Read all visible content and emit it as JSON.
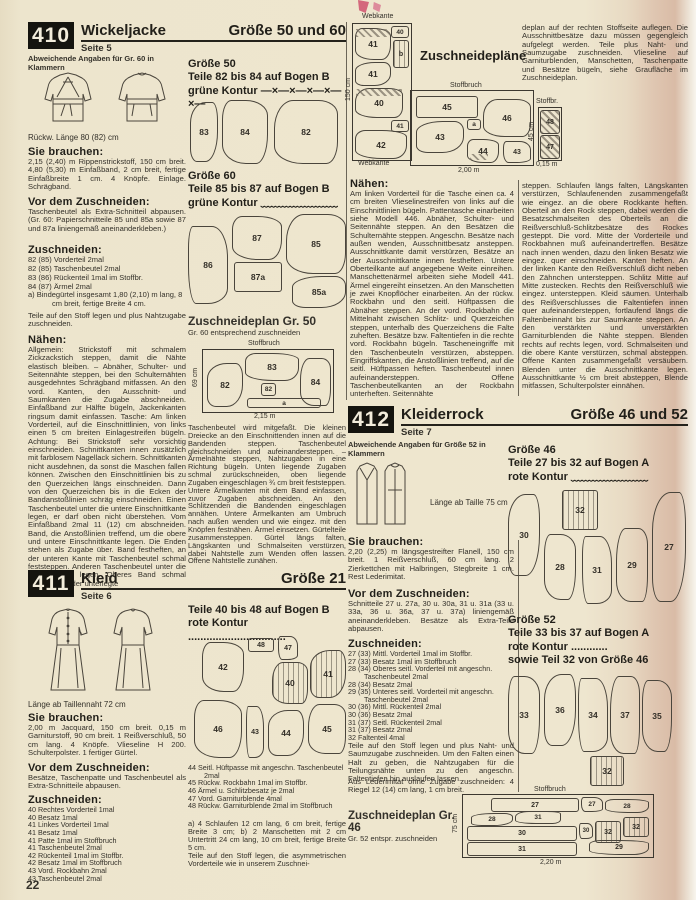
{
  "page": {
    "number": "22"
  },
  "labels": {
    "need": "Sie brauchen:",
    "before": "Vor dem Zuschneiden:",
    "cut": "Zuschneiden:",
    "sew": "Nähen:"
  },
  "m410": {
    "id": "410",
    "title": "Wickeljacke",
    "page_ref": "Seite 5",
    "size": "Größe 50 und 60",
    "note": "Abweichende Angaben für Gr. 60 in Klammern",
    "back_length": "Rückw. Länge 80 (82) cm",
    "need": "2,15 (2,40) m Rippenstrickstoff, 150 cm breit. 4,80 (5,30) m Einfaßband, 2 cm breit, fertige Einfaßbreite 1 cm. 4 Knöpfe. Einlage. Schrägband.",
    "before": "Taschenbeutel als Extra-Schnitteil abpausen. (Gr. 60: Papierschnitteile 85 und 85a sowie 87 und 87a liniengemäß aneinanderkleben.)",
    "cut_items": [
      "82 (85) Vorderteil 2mal",
      "82 (85) Taschenbeutel 2mal",
      "83 (86) Rückenteil 1mal im Stoffbr.",
      "84 (87) Ärmel 2mal",
      "a) Bindegürtel insgesamt 1,80 (2,10) m lang, 8 cm breit, fertige Breite 4 cm."
    ],
    "cut_note": "Teile auf den Stoff legen und plus Nahtzugabe zuschneiden.",
    "sew1": "Allgemein: Strickstoff mit schmalem Zickzackstich steppen, damit die Nähte elastisch bleiben. – Abnäher, Schulter- und Seitennähte steppen, bei den Schulternähten ausgedehntes Schrägband mitfassen. An den vord. Kanten, den Ausschnitt- und Saumkanten die Zugabe abschneiden. Einfaßband zur Hälfte bügeln, Jackenkanten ringsum damit einfassen. Tasche: Am linken Vorderteil, auf die Einschnittlinien, von links einen 5 cm breiten Einlagestreifen bügeln. Achtung: Bei Strickstoff sehr vorsichtig einschneiden. Schnittkanten innen zusätzlich mit farblosem Nagellack sichern. Schnittkanten nicht ausdehnen, da sonst die Maschen fallen können. Zwischen den Einschnittlinien bis zu den Querzeichen längs einschneiden. Dann von den Querzeichen bis in die Ecken der Bandanstoßlinien schräg einschneiden. Einen Taschenbeutel unter die untere Einschnittkante legen, er darf oben nicht überstehen. Vom Einfaßband 2mal 11 (12) cm abschneiden. Band, die Anstoßlinien treffend, um die obere und untere Einschnittkante legen. Die Enden stehen als Zugabe über. Band festheften, an der unteren Kante mit Taschenbeutel schmal feststeppen. Anderen Taschenbeutel unter die obere Kante legen. Oberes Band schmal feststeppen, der unterlegte",
    "sew2": "Taschenbeutel wird mitgefaßt. Die kleinen Dreiecke an den Einschnittenden innen auf die Bandenden steppen. Taschenbeutel gleichschneiden und aufeinandersteppen. – Ärmelnähte steppen, Nahtzugaben in eine Richtung bügeln. Unten liegende Zugaben schmal zurückschneiden, oben liegende Zugaben eingeschlagen ¾ cm breit feststeppen. Untere Ärmelkanten mit dem Band einfassen, zuvor Zugaben abschneiden. An den Schlitzenden die Bandenden eingeschlagen annähen. Untere Ärmelkanten am Umbruch nach außen wenden und wie eingez. mit den Knöpfen festnähen. Ärmel einsetzen. Gürtelteile zusammensteppen. Gürtel längs falten, Längskanten und Schmalseiten verstürzen, dabei Nahtstelle zum Wenden offen lassen. Offene Nahtstelle zunähen.",
    "size50": {
      "t1": "Größe 50",
      "t2": "Teile 82 bis 84 auf Bogen B",
      "t3": "grüne Kontur",
      "marks": "—×—×—×—×—×—",
      "pieces": [
        "83",
        "84",
        "82"
      ]
    },
    "size60": {
      "t1": "Größe 60",
      "t2": "Teile 85 bis 87 auf Bogen B",
      "t3": "grüne Kontur",
      "marks": "﹏﹏﹏﹏﹏﹏﹏",
      "pieces": [
        "86",
        "87",
        "87a",
        "85",
        "85a"
      ]
    },
    "plan": {
      "t": "Zuschneideplan Gr. 50",
      "sub": "Gr. 60 entsprechend zuschneiden",
      "fold": "Stoffbruch",
      "h": "69 cm",
      "w": "2,15 m",
      "pieces": [
        "82",
        "83",
        "82",
        "a",
        "84"
      ]
    }
  },
  "m411": {
    "id": "411",
    "title": "Kleid",
    "page_ref": "Seite 6",
    "size": "Größe 21",
    "length": "Länge ab Taillennaht 72 cm",
    "need": "2,00 m Jacquard, 150 cm breit. 0,15 m Garniturstoff, 90 cm breit. 1 Reißverschluß, 50 cm lang. 4 Knöpfe. Vlieseline H 200. Schulterpolster. 1 fertiger Gürtel.",
    "before": "Besätze, Taschenpatte und Taschenbeutel als Extra-Schnitteile abpausen.",
    "cut_items": [
      "40 Rechtes Vorderteil 1mal",
      "40 Besatz 1mal",
      "41 Linkes Vorderteil 1mal",
      "41 Besatz 1mal",
      "41 Patte 1mal im Stoffbruch",
      "41 Taschenbeutel 2mal",
      "42 Rückenteil 1mal im Stoffbr.",
      "42 Besatz 1mal im Stoffbruch",
      "43 Vord. Rockbahn 2mal",
      "43 Taschenbeutel 2mal"
    ],
    "pieces_t1": "Teile 40 bis 48 auf Bogen B",
    "pieces_t2": "rote Kontur",
    "dots": "................................",
    "pieces": [
      "42",
      "48",
      "47",
      "40",
      "41",
      "46",
      "43",
      "44",
      "45"
    ],
    "cut2_items": [
      "44 Seitl. Hüftpasse mit angeschn. Taschenbeutel 2mal",
      "45 Rückw. Rockbahn 1mal im Stoffbr.",
      "46 Ärmel u. Schlitzbesatz je 2mal",
      "47 Vord. Garniturblende 4mal",
      "48 Rückw. Garniturblende 2mal im Stoffbruch"
    ],
    "cut2_ab": "a) 4 Schlaufen 12 cm lang, 6 cm breit, fertige Breite 3 cm; b) 2 Manschetten mit 2 cm Untertritt 24 cm lang, 10 cm breit, fertige Breite 5 cm.",
    "cut2_note": "Teile auf den Stoff legen, die asymmetrischen Vorderteile wie in unserem Zuschnei-",
    "plans": {
      "title": "Zuschneidepläne",
      "selvage_top": "Webkante",
      "selvage_bottom": "Webkante",
      "width_label": "150 cm",
      "fold": "Stoffbruch",
      "len": "2,00 m",
      "left_pieces": [
        "40",
        "41",
        "b",
        "41",
        "40",
        "41",
        "42"
      ],
      "right_pieces": [
        "45",
        "46",
        "a",
        "43",
        "44",
        "43"
      ],
      "small": {
        "fold": "Stoffbr.",
        "h": "45 cm",
        "w": "0,15 m",
        "pieces": [
          "48",
          "47"
        ]
      }
    },
    "cont_top": "deplan auf der rechten Stoffseite auflegen. Die Ausschnittbesätze dazu müssen gegengleich aufgelegt werden. Teile plus Naht- und Saumzugabe zuschneiden. Vlieseline auf Garniturblenden, Manschetten, Taschenpatte und Besätze bügeln, siehe Graufläche im Zuschneideplan.",
    "sew": "Am linken Vorderteil für die Tasche einen ca. 4 cm breiten Vlieselinestreifen von links auf die Einschnittlinien bügeln. Pattentasche einarbeiten siehe Modell 446. Abnäher, Schulter- und Seitennähte steppen. An den Besätzen die Schulternähte steppen. Angeschn. Besätze nach außen wenden, Ausschnittbesatz ansteppen. Ausschnittkante damit verstürzen, Besätze an der Ausschnittkante innen festheften. Untere Oberteilkante auf angegebene Weite einreihen. Manschettenärmel arbeiten siehe Modell 441. Ärmel eingereiht einsetzen. An den Manschetten je zwei Knopflöcher einarbeiten. An der rückw. Rockbahn und den seitl. Hüftpassen die Abnäher steppen. An der vord. Rockbahn die Mittelnaht zwischen Schlitz- und Querzeichen steppen, unterhalb des Querzeichens die Falte zuheften. Besätze bzw. Faltentiefen in die rechte vord. Rockbahn bügeln. Tascheneingriffe mit den Taschenbeuteln verstürzen, absteppen. Eingriffskanten, die Anstoßlinien treffend, auf die seitl. Hüftpassen heften. Taschenbeutel innen aufeinandersteppen. Offene Taschenbeutelkanten an der Rockbahn unterheften. Seitennähte",
    "cont": "steppen. Schlaufen längs falten, Längskanten verstürzen, Schlaufenenden zusammengefaßt wie eingez. an die obere Rockkante heften. Oberteil an den Rock steppen, dabei werden die Besatzschmalseiten des Oberteils an die Reißverschluß-Schlitzbesätze des Rockes gesteppt. Die vord. Mitte der Vorderteile und Rockbahnen muß aufeinandertreffen. Besätze nach innen wenden, dazu den linken Besatz wie eingez. quer einschneiden. Kanten heften. An der linken Kante den Reißverschluß dicht neben den Zähnchen untersteppen. Schlitz Mitte auf Mitte zustecken. Rechts den Reißverschluß wie eingez. untersteppen. Kleid säumen. Unterhalb des Reißverschlusses die Faltentiefen innen quer aufeinandersteppen, fortlaufend längs die Faltenbeinnaht bis zur Saumkante steppen. An den verstärkten und unverstärkten Garniturblenden die Nähte steppen. Blenden rechts auf rechts legen, vord. Schmalseiten und die obere Kante verstürzen, schmal absteppen. Offene Kanten zusammengefaßt versäubern. Blenden unter die Ausschnittkante legen. Ausschnittkante ½ cm breit absteppen, Blende mitfassen, Schulterpolster einnähen."
  },
  "m412": {
    "id": "412",
    "title": "Kleiderrock",
    "page_ref": "Seite 7",
    "size": "Größe 46 und 52",
    "note": "Abweichende Angaben für Größe 52 in Klammern",
    "length": "Länge ab Taille 75 cm",
    "need": "2,20 (2,25) m längsgestreifter Flanell, 150 cm breit. 1 Reißverschluß, 60 cm lang. 2 Zierkettchen mit Halbringen, Stegbreite 1 cm. Rest Lederimitat.",
    "before": "Schnitteile 27 u. 27a, 30 u. 30a, 31 u. 31a (33 u. 33a, 36 u. 36a, 37 u. 37a) liniengemäß aneinanderkleben. Besätze als Extra-Teile abpausen.",
    "cut_items": [
      "27 (33) Mittl. Vorderteil 1mal im Stoffbr.",
      "27 (33) Besatz 1mal im Stoffbruch",
      "28 (34) Oberes seitl. Vorderteil mit angeschn. Taschenbeutel 2mal",
      "28 (34) Besatz 2mal",
      "29 (35) Unteres seitl. Vorderteil mit angeschn. Taschenbeutel 2mal",
      "30 (36) Mittl. Rückenteil 2mal",
      "30 (36) Besatz 2mal",
      "31 (37) Seitl. Rückenteil 2mal",
      "31 (37) Besatz 2mal",
      "32 Faltenteil 4mal"
    ],
    "cut_note1": "Teile auf den Stoff legen und plus Naht- und Saumzugabe zuschneiden. Um den Falten einen Halt zu geben, die Nahtzugaben für die Teilungsnähte unten zu den angeschn. Faltentiefen hin auslaufen lassen.",
    "cut_note2": "Aus Lederimitat ohne Zugabe zuschneiden: 4 Riegel 12 (14) cm lang, 1 cm breit.",
    "size46": {
      "t1": "Größe 46",
      "t2": "Teile 27 bis 32 auf Bogen A",
      "t3": "rote Kontur",
      "marks": "﹏﹏﹏﹏﹏﹏﹏",
      "pieces": [
        "30",
        "32",
        "28",
        "31",
        "29",
        "27"
      ]
    },
    "size52": {
      "t1": "Größe 52",
      "t2": "Teile 33 bis 37 auf Bogen A",
      "t3": "rote Kontur",
      "marks": "............",
      "t4": "sowie Teil 32 von Größe 46",
      "pieces": [
        "33",
        "36",
        "34",
        "37",
        "35",
        "32"
      ]
    },
    "plan": {
      "t": "Zuschneideplan Gr. 46",
      "sub": "Gr. 52 entspr. zuschneiden",
      "fold": "Stoffbruch",
      "h": "75 cm",
      "w": "2,20 m",
      "pieces": [
        "27",
        "27",
        "28",
        "28",
        "31",
        "30",
        "30",
        "32",
        "32",
        "31",
        "29"
      ]
    }
  }
}
